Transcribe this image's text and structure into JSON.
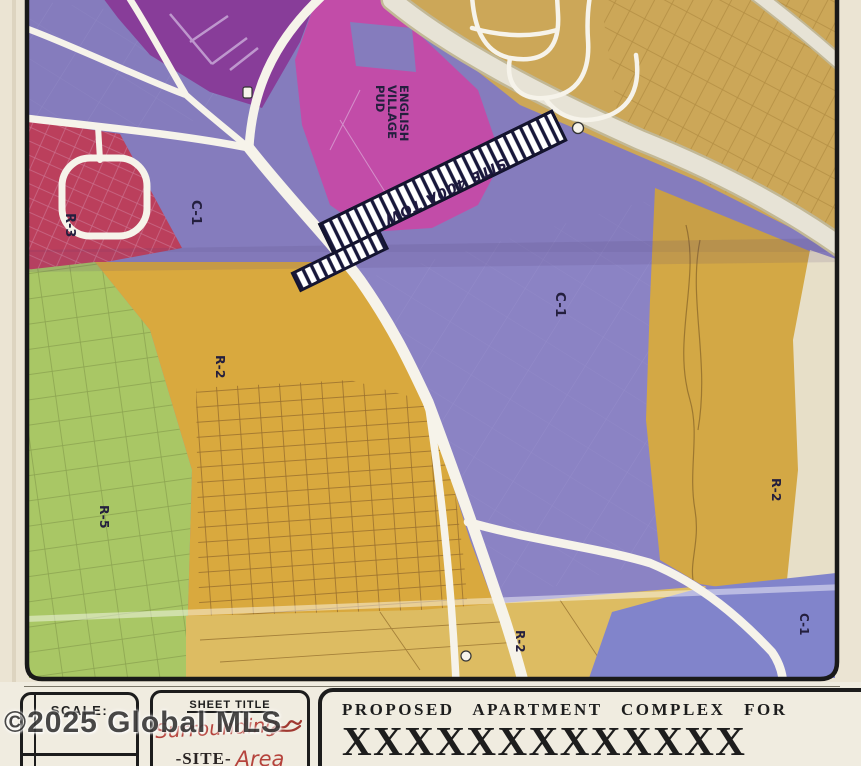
{
  "document": {
    "type": "scanned zoning map sheet",
    "description": "Surrounding site area zoning map for a proposed apartment complex"
  },
  "map": {
    "zone_labels": [
      {
        "id": "r3-left",
        "text": "R-3"
      },
      {
        "id": "c1-upper-left",
        "text": "C-1"
      },
      {
        "id": "english-village-pud",
        "lines": [
          "ENGLISH",
          "VILLAGE",
          "PUD"
        ]
      },
      {
        "id": "c1-center",
        "text": "C-1"
      },
      {
        "id": "r2-left",
        "text": "R-2"
      },
      {
        "id": "r5-left",
        "text": "R-5"
      },
      {
        "id": "r2-right",
        "text": "R-2"
      },
      {
        "id": "c1-bottom-right",
        "text": "C-1"
      },
      {
        "id": "r2-bottom",
        "text": "R-2"
      }
    ],
    "site_strip": {
      "label": "SITE 400A TOW",
      "style": "black hatched strip along highway"
    },
    "colors": {
      "c1_purple": "#8b83c4",
      "dark_purple": "#8e3f9e",
      "pud_magenta": "#cd4fae",
      "r3_red": "#c5415c",
      "r5_green": "#a9c765",
      "r2_gold": "#d9a93e",
      "gold_top_right": "#d8b158",
      "road_white": "#f6f3ea",
      "paper": "#ece6d6",
      "border_black": "#191919"
    }
  },
  "title_block": {
    "scale_label": "SCALE:",
    "sheet_title_label": "SHEET TITLE",
    "handwritten_top": "Surrounding",
    "site_word": "-SITE-",
    "handwritten_area": "Area",
    "proposed_line1": "PROPOSED  APARTMENT  COMPLEX  FOR",
    "proposed_line2": "XXXXXXXXXXXXX"
  },
  "watermark": "©2025 Global MLS"
}
